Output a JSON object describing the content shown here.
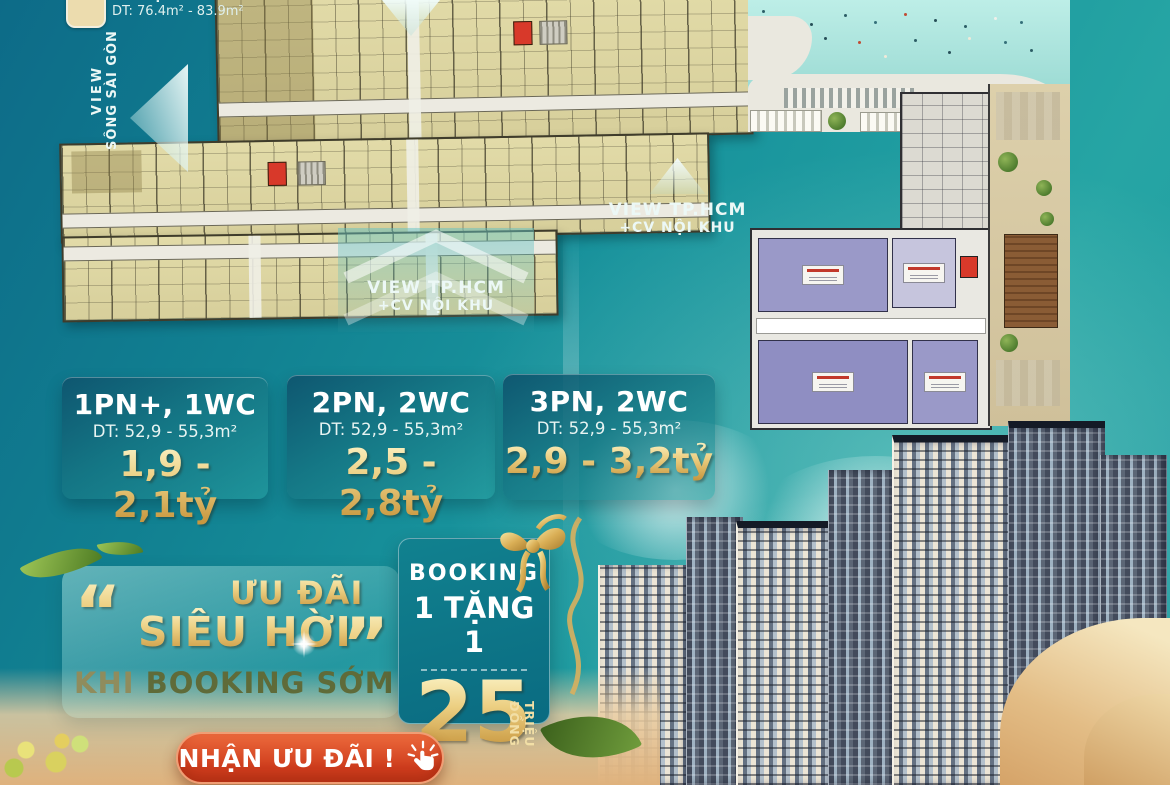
{
  "poster": {
    "legend": {
      "unit_label": "Căn hộ 3PN 2WC",
      "unit_area": "DT: 76.4m² - 83.9m²"
    },
    "view_labels": {
      "river": {
        "line1": "VIEW",
        "line2": "SÔNG SÀI GÒN"
      },
      "city_top": {
        "line1": "VIEW TP.HCM",
        "line2": "+CV NỘI KHU"
      },
      "city_mid": {
        "line1": "VIEW TP.HCM",
        "line2": "+CV NỘI KHU"
      }
    },
    "unit_cards": [
      {
        "type": "1PN+, 1WC",
        "area": "DT: 52,9 - 55,3m²",
        "price": "1,9 - 2,1tỷ"
      },
      {
        "type": "2PN, 2WC",
        "area": "DT: 52,9 - 55,3m²",
        "price": "2,5 - 2,8tỷ"
      },
      {
        "type": "3PN, 2WC",
        "area": "DT: 52,9 - 55,3m²",
        "price": "2,9 - 3,2tỷ"
      }
    ],
    "promo": {
      "open_quote": "“",
      "close_quote": "”",
      "line1": "ƯU ĐÃI",
      "line2": "SIÊU HỜI",
      "line3_prefix": "KHI",
      "line3_rest": " BOOKING SỚM"
    },
    "booking_offer": {
      "title": "BOOKING",
      "subtitle": "1 TẶNG 1",
      "amount": "25",
      "amount_unit": "TRIỆU ĐỒNG"
    },
    "cta": {
      "label": "NHẬN ƯU ĐÃI !"
    },
    "colors": {
      "background_teal": "#18939c",
      "gold": "#eccf82",
      "button_orange": "#d84a2b",
      "pool_water": "#a9e2db",
      "plan_beige": "#e2dba8",
      "shop_purple": "#9a99c8",
      "core_red": "#d8392a",
      "sand": "#e7c99e"
    }
  }
}
